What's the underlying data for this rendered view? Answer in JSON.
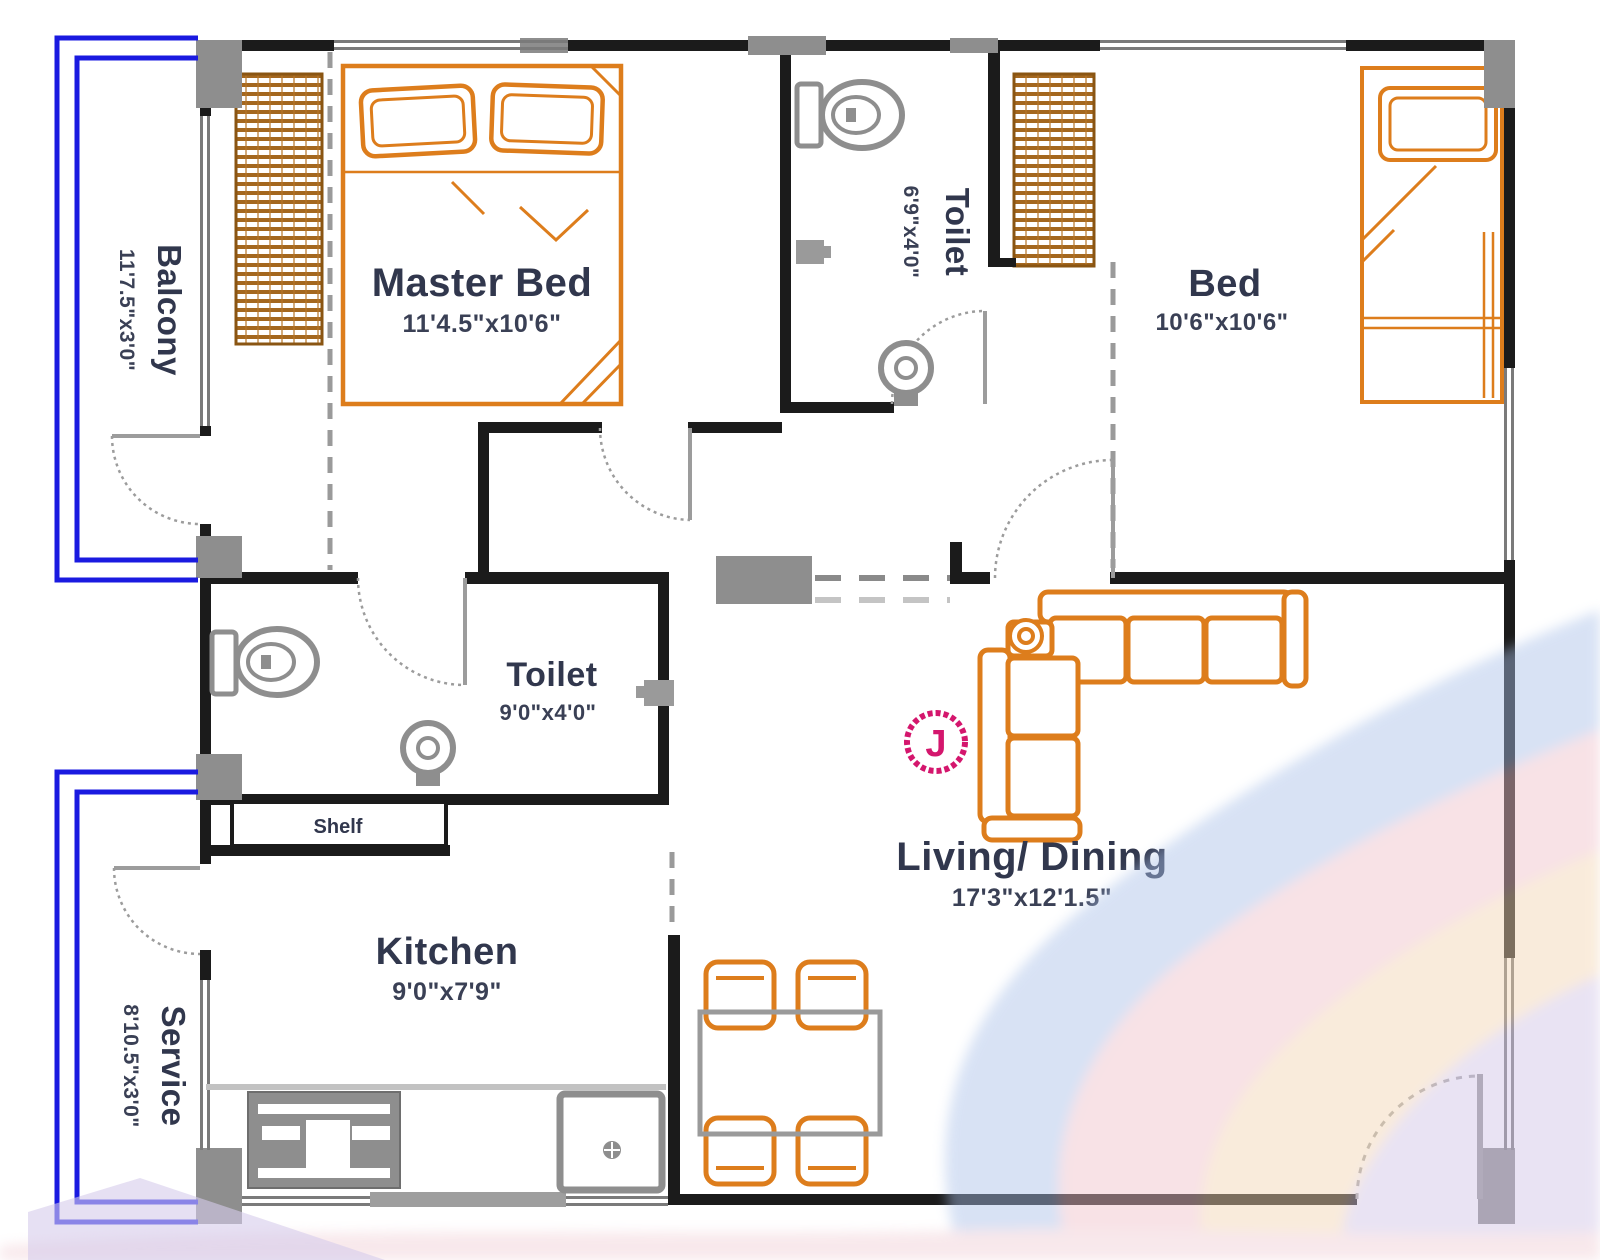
{
  "floorplan": {
    "rooms": {
      "master_bed": {
        "name": "Master Bed",
        "dim": "11'4.5\"x10'6\""
      },
      "toilet_top": {
        "name": "Toilet",
        "dim": "6'9\"x4'0\""
      },
      "bed": {
        "name": "Bed",
        "dim": "10'6\"x10'6\""
      },
      "balcony": {
        "name": "Balcony",
        "dim": "11'7.5\"x3'0\""
      },
      "toilet_mid": {
        "name": "Toilet",
        "dim": "9'0\"x4'0\""
      },
      "shelf": {
        "name": "Shelf"
      },
      "kitchen": {
        "name": "Kitchen",
        "dim": "9'0\"x7'9\""
      },
      "service": {
        "name": "Service",
        "dim": "8'10.5\"x3'0\""
      },
      "living_dining": {
        "name": "Living/ Dining",
        "dim": "17'3\"x12'1.5\""
      }
    },
    "marker": {
      "label": "J"
    },
    "colors": {
      "wall": "#1b1b1b",
      "column": "#8e8e8e",
      "furniture": "#dd7d1c",
      "wardrobe_hatch": "#a4671e",
      "balcony_line": "#1a1ae0",
      "marker": "#d4166d",
      "fixture": "#8e8e8e",
      "text": "#31374d"
    }
  }
}
